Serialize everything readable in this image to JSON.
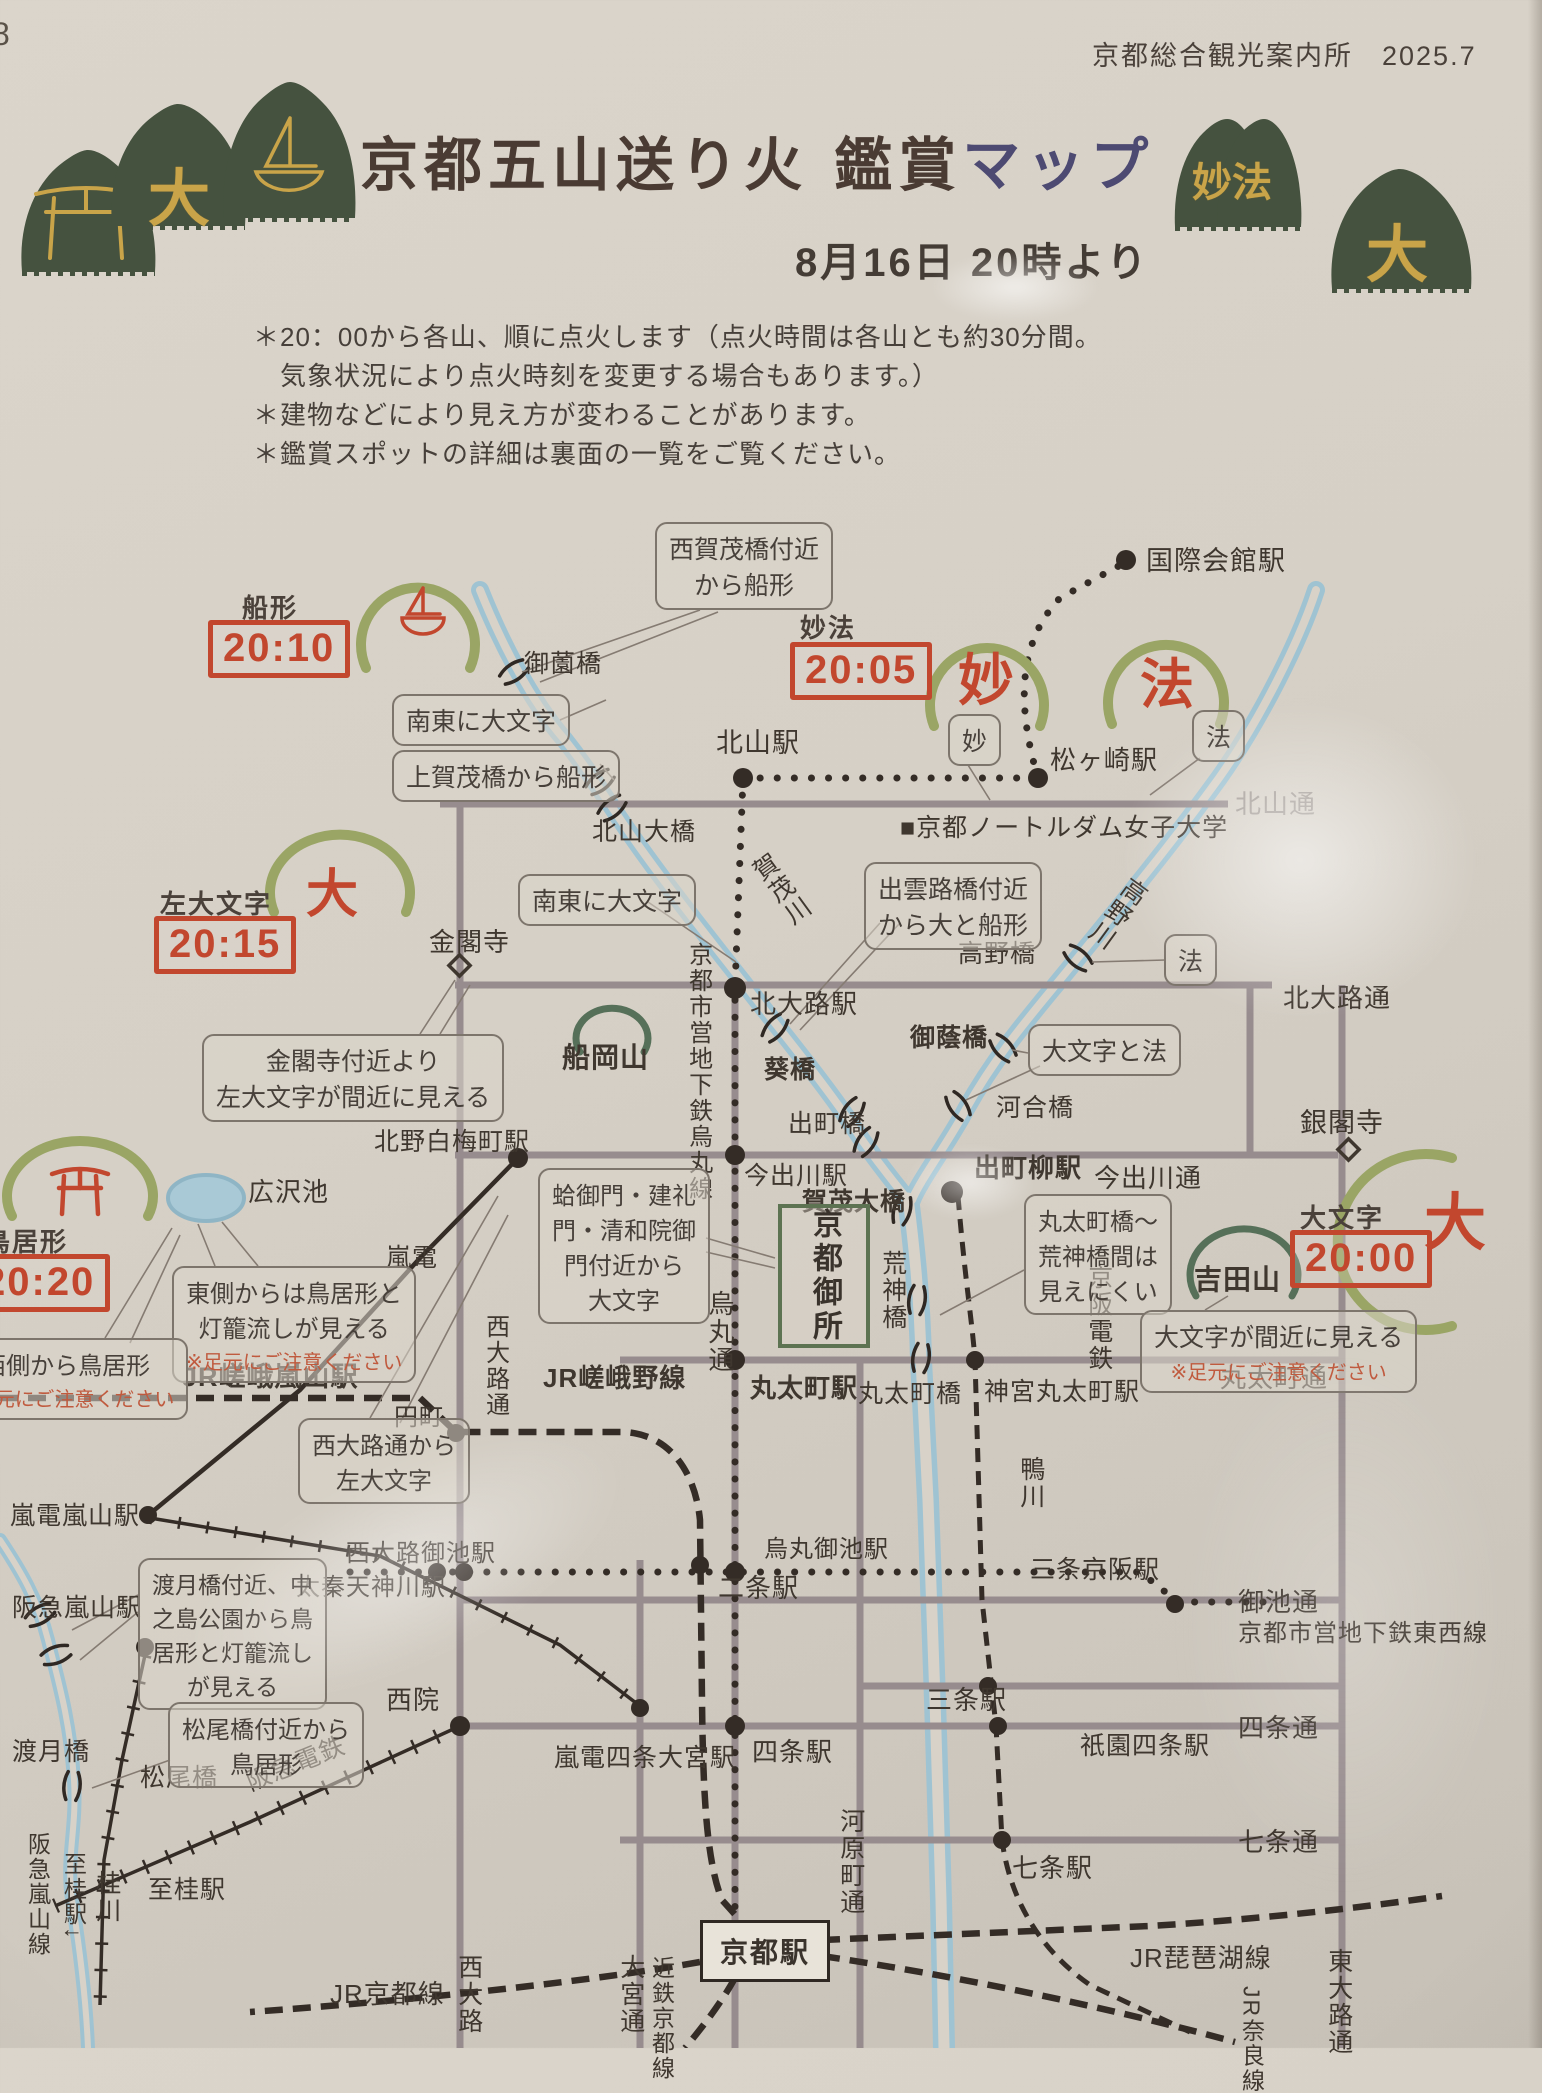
{
  "page": {
    "corner_number": "8",
    "credit": "京都総合観光案内所　2025.7"
  },
  "header": {
    "title_main": "京都五山送り火 鑑賞",
    "title_accent": "マップ",
    "date_line": "8月16日 20時より",
    "notes": [
      "＊20：00から各山、順に点火します（点火時間は各山とも約30分間。",
      "　気象状況により点火時刻を変更する場合もあります。）",
      "＊建物などにより見え方が変わることがあります。",
      "＊鑑賞スポットの詳細は裏面の一覧をご覧ください。"
    ]
  },
  "colors": {
    "stamp_red": "#c2472e",
    "mountain_green": "#9aa565",
    "hill_green": "#567059",
    "river_blue": "#9fc3d2",
    "title_accent": "#4d4a72",
    "note_red": "#c05a3e",
    "road_gray": "#978c8e",
    "rail_black": "#342c26",
    "icon_green": "#45523f",
    "icon_gold": "#c9a449"
  },
  "stamps": [
    {
      "id": "funagata",
      "name": "船形",
      "time": "20:10",
      "lx": 242,
      "ly": 588,
      "bx": 208,
      "by": 620
    },
    {
      "id": "myoho",
      "name": "妙法",
      "time": "20:05",
      "lx": 800,
      "ly": 608,
      "bx": 790,
      "by": 642
    },
    {
      "id": "hidari-daimonji",
      "name": "左大文字",
      "time": "20:15",
      "lx": 160,
      "ly": 884,
      "bx": 154,
      "by": 916
    },
    {
      "id": "toriigata",
      "name": "鳥居形",
      "time": "20:20",
      "lx": -16,
      "ly": 1222,
      "bx": -32,
      "by": 1254
    },
    {
      "id": "daimonji",
      "name": "大文字",
      "time": "20:00",
      "lx": 1300,
      "ly": 1198,
      "bx": 1290,
      "by": 1230
    }
  ],
  "mountain_chars": [
    {
      "id": "myo-char",
      "t": "妙",
      "x": 958,
      "y": 636,
      "fs": 56
    },
    {
      "id": "ho-char",
      "t": "法",
      "x": 1140,
      "y": 640,
      "fs": 54
    },
    {
      "id": "dai-left-char",
      "t": "大",
      "x": 306,
      "y": 852,
      "fs": 52
    },
    {
      "id": "dai-right-char",
      "t": "大",
      "x": 1424,
      "y": 1172,
      "fs": 62
    }
  ],
  "gold_chars": [
    {
      "id": "dai-left-gold",
      "t": "大",
      "x": 148,
      "y": 148,
      "fs": 62
    },
    {
      "id": "myoho-gold",
      "t": "妙法",
      "x": 1192,
      "y": 150,
      "fs": 40
    },
    {
      "id": "dai-right-gold",
      "t": "大",
      "x": 1366,
      "y": 204,
      "fs": 62
    }
  ],
  "callouts": [
    {
      "id": "nishigamo-spot",
      "lines": [
        "西賀茂橋付近",
        "から船形"
      ],
      "x": 655,
      "y": 522,
      "fs": 25
    },
    {
      "id": "nanto-daimonji-1",
      "lines": [
        "南東に大文字"
      ],
      "x": 392,
      "y": 694,
      "fs": 25
    },
    {
      "id": "kamigamo-spot",
      "lines": [
        "上賀茂橋から船形"
      ],
      "x": 392,
      "y": 750,
      "fs": 25
    },
    {
      "id": "myo-spot",
      "lines": [
        "妙"
      ],
      "x": 948,
      "y": 714,
      "fs": 25
    },
    {
      "id": "ho-spot-1",
      "lines": [
        "法"
      ],
      "x": 1192,
      "y": 710,
      "fs": 25
    },
    {
      "id": "ho-spot-2",
      "lines": [
        "法"
      ],
      "x": 1164,
      "y": 934,
      "fs": 25
    },
    {
      "id": "izumoji-spot",
      "lines": [
        "出雲路橋付近",
        "から大と船形"
      ],
      "x": 864,
      "y": 862,
      "fs": 25
    },
    {
      "id": "nanto-daimonji-2",
      "lines": [
        "南東に大文字"
      ],
      "x": 518,
      "y": 874,
      "fs": 25
    },
    {
      "id": "kinkakuji-spot",
      "lines": [
        "金閣寺付近より",
        "左大文字が間近に見える"
      ],
      "x": 202,
      "y": 1034,
      "fs": 25
    },
    {
      "id": "daimonji-to-ho",
      "lines": [
        "大文字と法"
      ],
      "x": 1028,
      "y": 1024,
      "fs": 25
    },
    {
      "id": "marutamachi-kojin",
      "lines": [
        "丸太町橋〜",
        "荒神橋間は",
        "見えにくい"
      ],
      "x": 1024,
      "y": 1194,
      "fs": 24
    },
    {
      "id": "daimonji-up-close",
      "lines": [
        "大文字が間近に見える"
      ],
      "note": "※足元にご注意ください",
      "x": 1140,
      "y": 1310,
      "fs": 25
    },
    {
      "id": "east-torii",
      "lines": [
        "東側からは鳥居形と",
        "灯籠流しが見える"
      ],
      "note": "※足元にご注意ください",
      "x": 172,
      "y": 1266,
      "fs": 24
    },
    {
      "id": "west-torii",
      "lines": [
        "西側から鳥居形"
      ],
      "note": "※足元にご注意ください",
      "x": -56,
      "y": 1338,
      "fs": 24
    },
    {
      "id": "hamaguri-gomon",
      "lines": [
        "蛤御門・建礼",
        "門・清和院御",
        "門付近から",
        "大文字"
      ],
      "x": 538,
      "y": 1168,
      "fs": 24
    },
    {
      "id": "nishioji-spot",
      "lines": [
        "西大路通から",
        "左大文字"
      ],
      "x": 298,
      "y": 1418,
      "fs": 24
    },
    {
      "id": "togetsukyo-spot",
      "lines": [
        "渡月橋付近、中",
        "之島公園から鳥",
        "居形と灯籠流し",
        "が見える"
      ],
      "x": 138,
      "y": 1558,
      "fs": 23
    },
    {
      "id": "matsuobashi-spot",
      "lines": [
        "松尾橋付近から",
        "鳥居形"
      ],
      "x": 168,
      "y": 1702,
      "fs": 24
    }
  ],
  "boxes": [
    {
      "id": "kyoto-gosho",
      "text": "京都御所",
      "x": 778,
      "y": 1204,
      "w": 84,
      "h": 136,
      "style": "gosho"
    },
    {
      "id": "kyoto-station",
      "text": "京都駅",
      "x": 700,
      "y": 1920,
      "w": 124,
      "h": 56,
      "style": "station"
    }
  ],
  "labels": [
    {
      "id": "kokusaikaikan-sta",
      "t": "国際会館駅",
      "x": 1146,
      "y": 546,
      "fs": 27
    },
    {
      "id": "kitayama-sta",
      "t": "北山駅",
      "x": 716,
      "y": 728,
      "fs": 27
    },
    {
      "id": "matsugasaki-sta",
      "t": "松ヶ崎駅",
      "x": 1050,
      "y": 746,
      "fs": 26
    },
    {
      "id": "misonobashi",
      "t": "御薗橋",
      "x": 524,
      "y": 650,
      "fs": 25
    },
    {
      "id": "kitayama-ohashi",
      "t": "北山大橋",
      "x": 592,
      "y": 818,
      "fs": 25
    },
    {
      "id": "notredame-univ",
      "t": "■京都ノートルダム女子大学",
      "x": 900,
      "y": 814,
      "fs": 25
    },
    {
      "id": "kitayama-dori",
      "t": "北山通",
      "x": 1235,
      "y": 790,
      "fs": 26,
      "dim": 1
    },
    {
      "id": "kamogawa",
      "t": "賀茂川",
      "x": 766,
      "y": 850,
      "fs": 25,
      "v": 1,
      "r": -36
    },
    {
      "id": "takanogawa",
      "t": "高野川",
      "x": 1102,
      "y": 872,
      "fs": 25,
      "v": 1,
      "r": 36
    },
    {
      "id": "kitaoji-sta",
      "t": "北大路駅",
      "x": 750,
      "y": 990,
      "fs": 26
    },
    {
      "id": "kitaoji-dori",
      "t": "北大路通",
      "x": 1283,
      "y": 984,
      "fs": 26
    },
    {
      "id": "kinkakuji",
      "t": "金閣寺",
      "x": 429,
      "y": 928,
      "fs": 26
    },
    {
      "id": "funaokayama",
      "t": "船岡山",
      "x": 562,
      "y": 1042,
      "fs": 28,
      "b": 1
    },
    {
      "id": "aoibashi",
      "t": "葵橋",
      "x": 764,
      "y": 1056,
      "fs": 25,
      "b": 1
    },
    {
      "id": "demachibashi",
      "t": "出町橋",
      "x": 788,
      "y": 1110,
      "fs": 25
    },
    {
      "id": "mikagebashi",
      "t": "御蔭橋",
      "x": 910,
      "y": 1024,
      "fs": 25,
      "b": 1
    },
    {
      "id": "kawaibashi",
      "t": "河合橋",
      "x": 996,
      "y": 1094,
      "fs": 25
    },
    {
      "id": "takanobashi",
      "t": "高野橋",
      "x": 958,
      "y": 940,
      "fs": 25
    },
    {
      "id": "demachiyanagi-sta",
      "t": "出町柳駅",
      "x": 974,
      "y": 1154,
      "fs": 26,
      "b": 1
    },
    {
      "id": "imadegawa-dori",
      "t": "今出川通",
      "x": 1094,
      "y": 1164,
      "fs": 26
    },
    {
      "id": "ginkakuji",
      "t": "銀閣寺",
      "x": 1300,
      "y": 1108,
      "fs": 27
    },
    {
      "id": "imadegawa-sta",
      "t": "今出川駅",
      "x": 744,
      "y": 1162,
      "fs": 25
    },
    {
      "id": "kamo-ohashi",
      "t": "賀茂大橋",
      "x": 802,
      "y": 1188,
      "fs": 25,
      "b": 1
    },
    {
      "id": "karasuma-subway",
      "t": "京都市営地下鉄烏丸線",
      "x": 684,
      "y": 942,
      "fs": 24,
      "v": 1
    },
    {
      "id": "karasuma-dori",
      "t": "烏丸通",
      "x": 704,
      "y": 1290,
      "fs": 26,
      "v": 1
    },
    {
      "id": "kojinbashi",
      "t": "荒神橋",
      "x": 878,
      "y": 1250,
      "fs": 25,
      "v": 1
    },
    {
      "id": "keihan-dentetsu",
      "t": "京阪電鉄",
      "x": 1084,
      "y": 1264,
      "fs": 25,
      "v": 1
    },
    {
      "id": "kamogawa-s",
      "t": "鴨川",
      "x": 1016,
      "y": 1456,
      "fs": 25,
      "v": 1
    },
    {
      "id": "marutamachibashi",
      "t": "丸太町橋",
      "x": 858,
      "y": 1380,
      "fs": 25
    },
    {
      "id": "jingu-marutamachi-sta",
      "t": "神宮丸太町駅",
      "x": 984,
      "y": 1378,
      "fs": 25
    },
    {
      "id": "marutamachi-dori",
      "t": "丸太町通",
      "x": 1220,
      "y": 1364,
      "fs": 26
    },
    {
      "id": "marutamachi-sta",
      "t": "丸太町駅",
      "x": 750,
      "y": 1374,
      "fs": 26,
      "b": 1
    },
    {
      "id": "jr-sagano-line",
      "t": "JR嵯峨野線",
      "x": 543,
      "y": 1364,
      "fs": 26,
      "b": 1
    },
    {
      "id": "enmachi",
      "t": "円町",
      "x": 394,
      "y": 1404,
      "fs": 24
    },
    {
      "id": "nishioji-dori",
      "t": "西大路通",
      "x": 481,
      "y": 1314,
      "fs": 24,
      "v": 1
    },
    {
      "id": "kitano-hakubaicho-sta",
      "t": "北野白梅町駅",
      "x": 374,
      "y": 1128,
      "fs": 25
    },
    {
      "id": "hirosawa-ike",
      "t": "広沢池",
      "x": 248,
      "y": 1178,
      "fs": 26
    },
    {
      "id": "randen",
      "t": "嵐電",
      "x": 386,
      "y": 1244,
      "fs": 25
    },
    {
      "id": "jr-saga-arashiyama-sta",
      "t": "JR嵯峨嵐山駅",
      "x": 182,
      "y": 1362,
      "fs": 27,
      "b": 1
    },
    {
      "id": "randen-arashiyama-sta",
      "t": "嵐電嵐山駅",
      "x": 10,
      "y": 1502,
      "fs": 25
    },
    {
      "id": "hankyu-arashiyama-sta",
      "t": "阪急嵐山駅",
      "x": 12,
      "y": 1594,
      "fs": 25
    },
    {
      "id": "togetsukyo",
      "t": "渡月橋",
      "x": 12,
      "y": 1738,
      "fs": 25
    },
    {
      "id": "matsuobashi",
      "t": "松尾橋",
      "x": 140,
      "y": 1764,
      "fs": 25
    },
    {
      "id": "to-katsura",
      "t": "至桂駅",
      "x": 148,
      "y": 1876,
      "fs": 25
    },
    {
      "id": "hankyu-dentetsu",
      "t": "阪急電鉄",
      "x": 244,
      "y": 1750,
      "fs": 25,
      "r": -22
    },
    {
      "id": "hankyu-arashiyama-line",
      "t": "阪急嵐山線",
      "x": 24,
      "y": 1832,
      "fs": 23,
      "v": 1
    },
    {
      "id": "to-katsura-v",
      "t": "至桂駅↓",
      "x": 60,
      "y": 1852,
      "fs": 23,
      "v": 1
    },
    {
      "id": "katsuragawa",
      "t": "桂川",
      "x": 92,
      "y": 1870,
      "fs": 25,
      "v": 1
    },
    {
      "id": "saiin-sta",
      "t": "西院",
      "x": 386,
      "y": 1686,
      "fs": 26
    },
    {
      "id": "uzumasa-tenjingawa-sta",
      "t": "太秦天神川駅",
      "x": 296,
      "y": 1574,
      "fs": 24
    },
    {
      "id": "nishioji-oike-sta",
      "t": "西大路御池駅",
      "x": 346,
      "y": 1540,
      "fs": 24
    },
    {
      "id": "nijo-sta",
      "t": "二条駅",
      "x": 718,
      "y": 1574,
      "fs": 26
    },
    {
      "id": "karasuma-oike-sta",
      "t": "烏丸御池駅",
      "x": 764,
      "y": 1536,
      "fs": 24
    },
    {
      "id": "sanjo-keihan-sta",
      "t": "三条京阪駅",
      "x": 1030,
      "y": 1556,
      "fs": 25
    },
    {
      "id": "oike-dori",
      "t": "御池通",
      "x": 1238,
      "y": 1588,
      "fs": 26
    },
    {
      "id": "tozai-subway",
      "t": "京都市営地下鉄東西線",
      "x": 1238,
      "y": 1620,
      "fs": 24
    },
    {
      "id": "sanjo-sta",
      "t": "三条駅",
      "x": 926,
      "y": 1686,
      "fs": 26
    },
    {
      "id": "randen-shijo-omiya-sta",
      "t": "嵐電四条大宮駅",
      "x": 554,
      "y": 1744,
      "fs": 25
    },
    {
      "id": "shijo-sta",
      "t": "四条駅",
      "x": 752,
      "y": 1738,
      "fs": 26
    },
    {
      "id": "gion-shijo-sta",
      "t": "祇園四条駅",
      "x": 1080,
      "y": 1732,
      "fs": 25
    },
    {
      "id": "shijo-dori",
      "t": "四条通",
      "x": 1238,
      "y": 1714,
      "fs": 26
    },
    {
      "id": "kawaramachi-dori",
      "t": "河原町通",
      "x": 836,
      "y": 1808,
      "fs": 25,
      "v": 1
    },
    {
      "id": "shichijo-sta",
      "t": "七条駅",
      "x": 1012,
      "y": 1854,
      "fs": 26
    },
    {
      "id": "shichijo-dori",
      "t": "七条通",
      "x": 1238,
      "y": 1828,
      "fs": 26
    },
    {
      "id": "jr-biwako-line",
      "t": "JR琵琶湖線",
      "x": 1130,
      "y": 1944,
      "fs": 26
    },
    {
      "id": "jr-kyoto-line",
      "t": "JR京都線",
      "x": 330,
      "y": 1980,
      "fs": 26
    },
    {
      "id": "nishioji-bottom",
      "t": "西大路",
      "x": 454,
      "y": 1954,
      "fs": 25,
      "v": 1
    },
    {
      "id": "omiya-dori",
      "t": "大宮通",
      "x": 616,
      "y": 1954,
      "fs": 25,
      "v": 1
    },
    {
      "id": "kintetsu-kyoto-line",
      "t": "近鉄京都線",
      "x": 648,
      "y": 1956,
      "fs": 23,
      "v": 1
    },
    {
      "id": "higashioji-dori",
      "t": "東大路通",
      "x": 1324,
      "y": 1948,
      "fs": 25,
      "v": 1
    },
    {
      "id": "jr-nara-line",
      "t": "JR奈良線",
      "x": 1238,
      "y": 1986,
      "fs": 23,
      "v": 1
    },
    {
      "id": "yoshidayama",
      "t": "吉田山",
      "x": 1194,
      "y": 1264,
      "fs": 28,
      "b": 1
    }
  ]
}
